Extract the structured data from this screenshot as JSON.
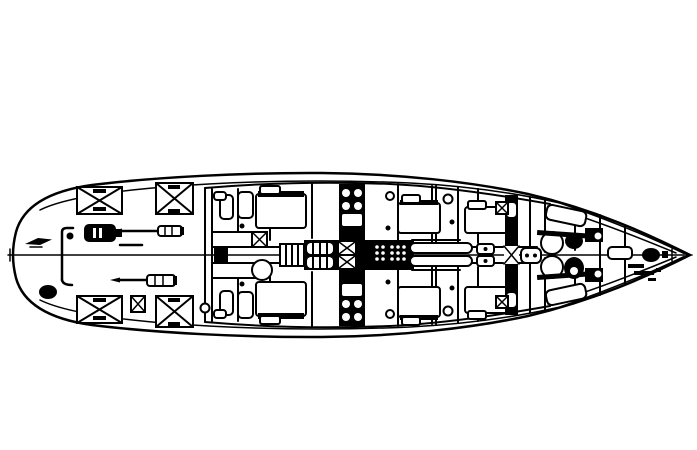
{
  "diagram": {
    "type": "technical-line-drawing",
    "subject_label": "Sailing yacht deck and accommodation plan, top view",
    "ink_color": "#000000",
    "background_color": "#ffffff",
    "orientation": {
      "bow": "right",
      "stern": "left",
      "centerline": "horizontal"
    },
    "features": [
      "hull-outline",
      "transom",
      "inner-sheer-line",
      "bow-bulwark-line",
      "centerline",
      "deckhouse-outline",
      "station-bulkheads",
      "aft-deck-skylight-hatches",
      "small-deck-hatch",
      "gas-tank",
      "winch-handles",
      "stern-cleat",
      "stern-fitting",
      "boarding-davit",
      "aft-cabin-berths",
      "cabin-doors",
      "companionway-ladder",
      "main-mast-station",
      "mast-step-lattice",
      "saloon-settee-table",
      "mid-cabin-berths",
      "galley-sinks",
      "forward-mast-station",
      "curved-seats",
      "v-berths",
      "anchor-windlass",
      "chain-pipe",
      "bow-fitting",
      "bow-tick-marks"
    ]
  }
}
